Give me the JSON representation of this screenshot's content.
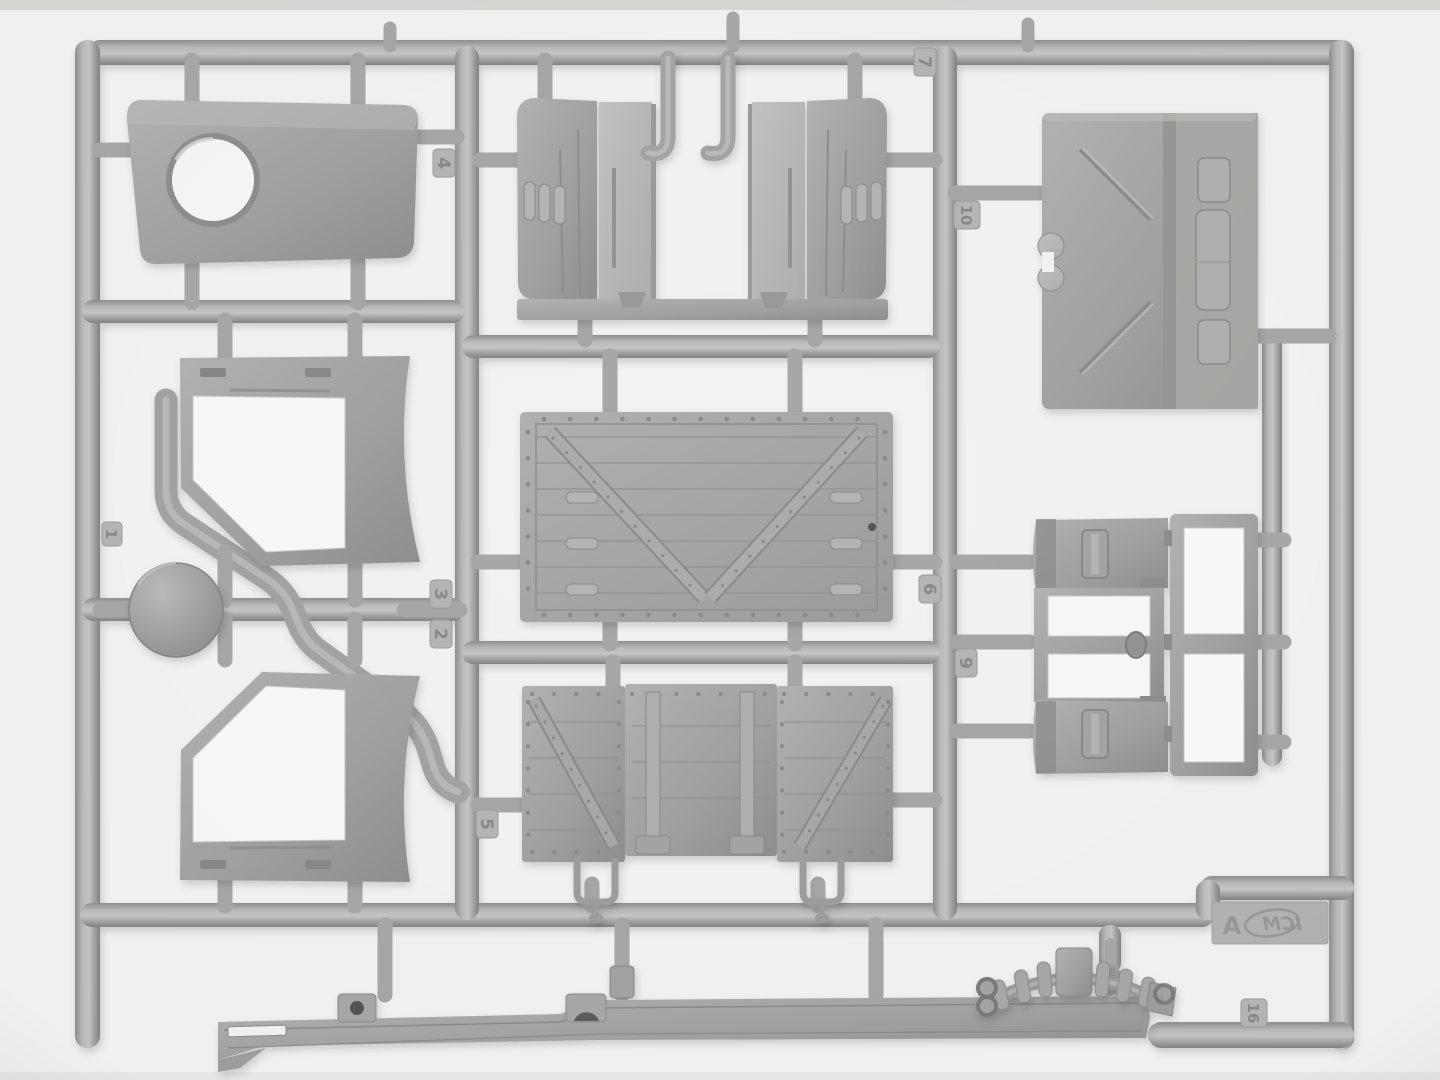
{
  "scene": {
    "subject": "Photograph of a plastic model-kit injection-molded sprue (runner) holding truck body parts in grey styrene",
    "background_color": "#f3f2f0",
    "plastic_base_color": "#a6a5a3",
    "plastic_highlight_color": "#c7c6c4",
    "plastic_shadow_color": "#858483"
  },
  "branding": {
    "logo_text": "ICM",
    "sprue_letter": "A"
  },
  "part_tags": [
    "1",
    "2",
    "3",
    "4",
    "5",
    "6",
    "7",
    "9",
    "10",
    "16"
  ],
  "parts": [
    {
      "name": "cab roof panel with circular hatch opening"
    },
    {
      "name": "door frame upper with curved fender blade"
    },
    {
      "name": "door frame lower with curved fender blade"
    },
    {
      "name": "round hatch disc"
    },
    {
      "name": "hood side panels with louvers"
    },
    {
      "name": "exhaust hook tubes"
    },
    {
      "name": "cab rear panel with recessed windows"
    },
    {
      "name": "cowl panels and windshield frames"
    },
    {
      "name": "cargo bed floor with V-brace and rivets"
    },
    {
      "name": "cargo bed side panels with braces and stirrups"
    },
    {
      "name": "chassis frame rail"
    },
    {
      "name": "leaf spring with clamps and shackles"
    }
  ]
}
